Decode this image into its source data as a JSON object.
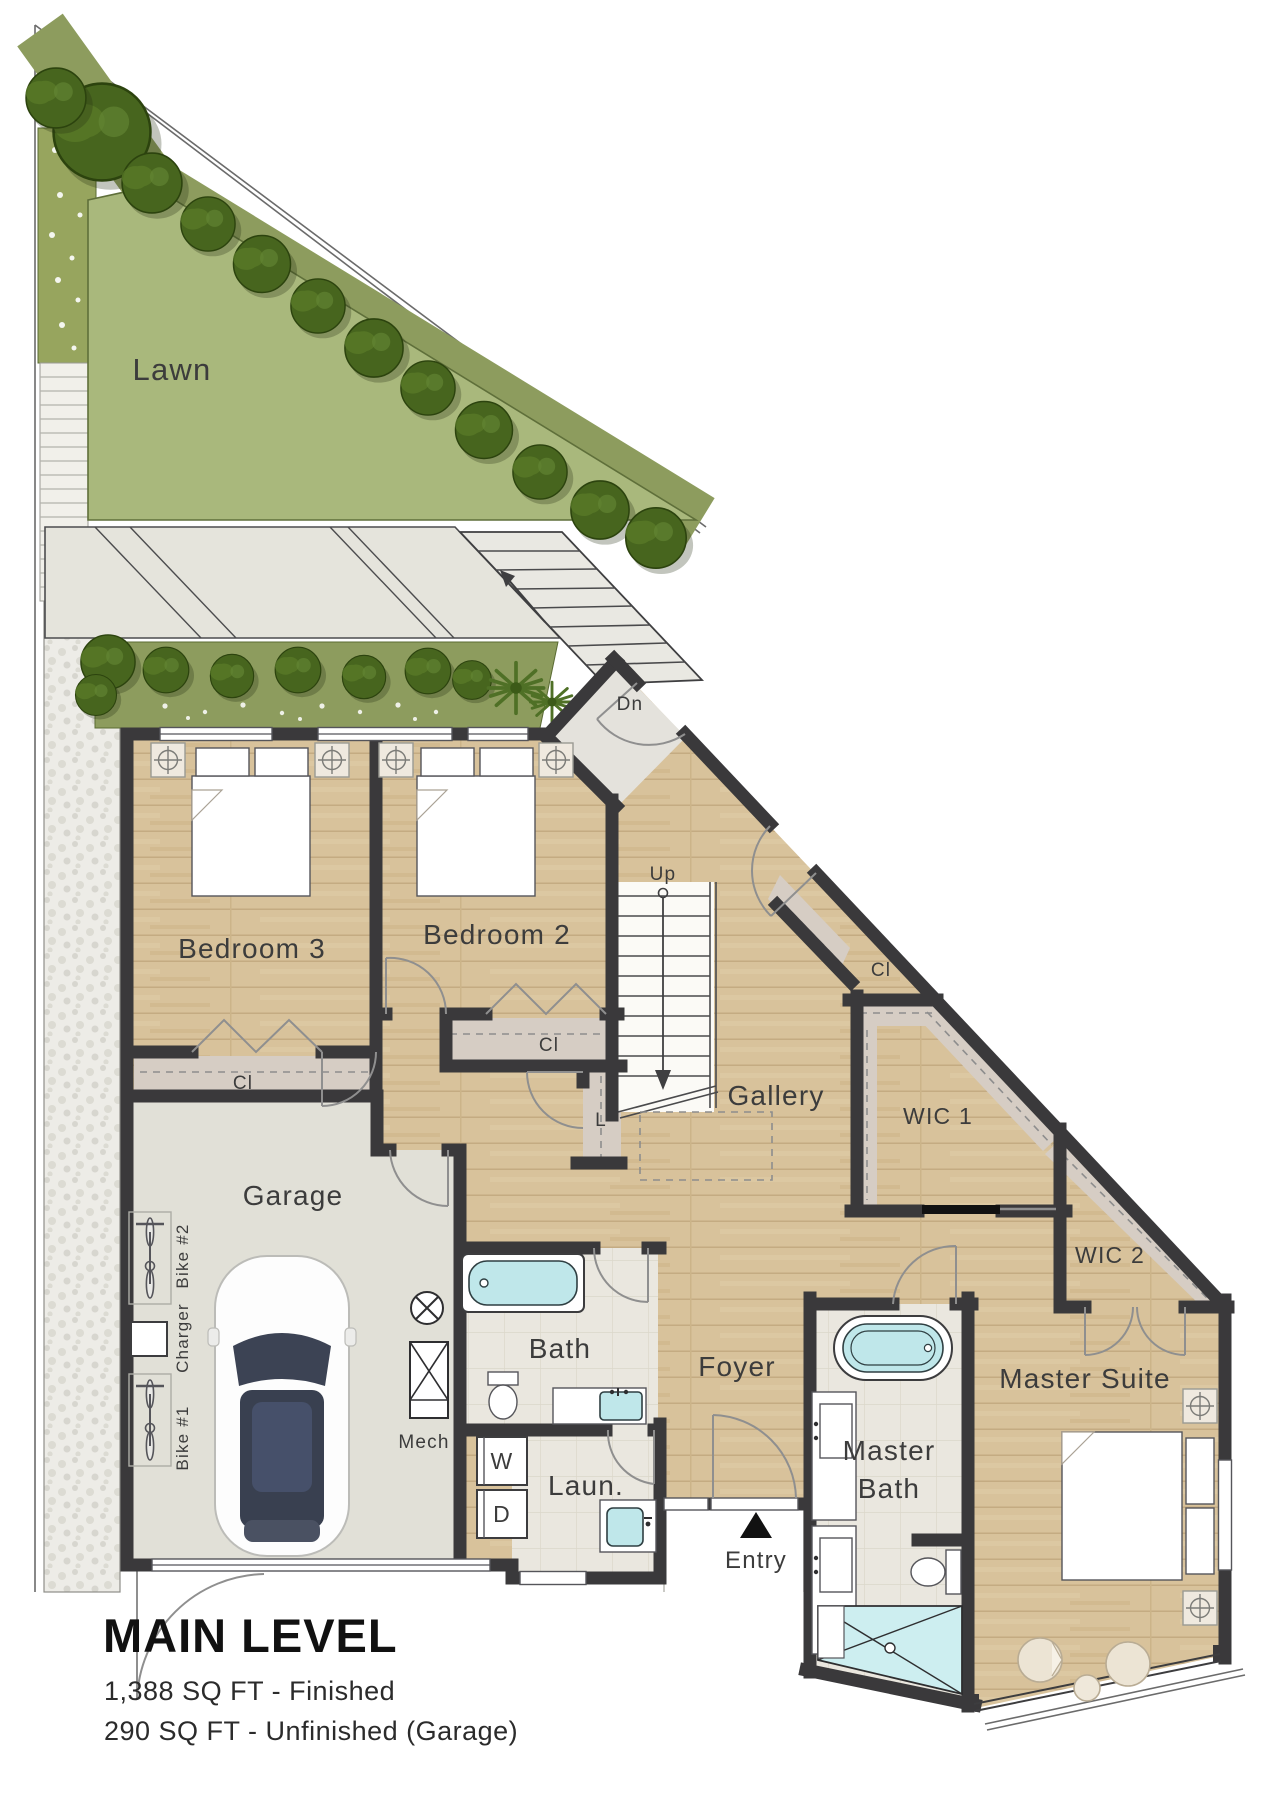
{
  "title_block": {
    "title": "MAIN LEVEL",
    "area_finished": "1,388 SQ FT - Finished",
    "area_unfinished": "290 SQ FT - Unfinished (Garage)"
  },
  "site": {
    "lawn": "Lawn",
    "exterior_stair_down": "Dn",
    "entry": "Entry"
  },
  "rooms": {
    "bedroom3": "Bedroom 3",
    "bedroom2": "Bedroom 2",
    "gallery": "Gallery",
    "garage": "Garage",
    "foyer": "Foyer",
    "bath": "Bath",
    "laundry": "Laun.",
    "master_bath_line1": "Master",
    "master_bath_line2": "Bath",
    "master_suite": "Master Suite",
    "wic1": "WIC 1",
    "wic2": "WIC 2",
    "mech": "Mech"
  },
  "closets": {
    "bedroom3": "Cl",
    "bedroom2": "Cl",
    "gallery": "Cl",
    "linen": "L"
  },
  "stairs": {
    "interior_up": "Up"
  },
  "garage_items": {
    "bike1": "Bike #1",
    "bike2": "Bike #2",
    "charger": "Charger"
  },
  "appliances": {
    "washer": "W",
    "dryer": "D"
  },
  "colors": {
    "walls": "#3a393b",
    "wood_floor": "#d8c29b",
    "lawn": "#a9b87c",
    "planting": "#8d9c5e",
    "trees": "#47651e",
    "water_fixtures": "#bfe7ea",
    "tile": "#eae7df",
    "garage_floor": "#e1e0d7",
    "closet_floor": "#d6cdc4",
    "stone_path": "#edece7",
    "label_text": "#3c3c3c",
    "title_text": "#111111"
  }
}
